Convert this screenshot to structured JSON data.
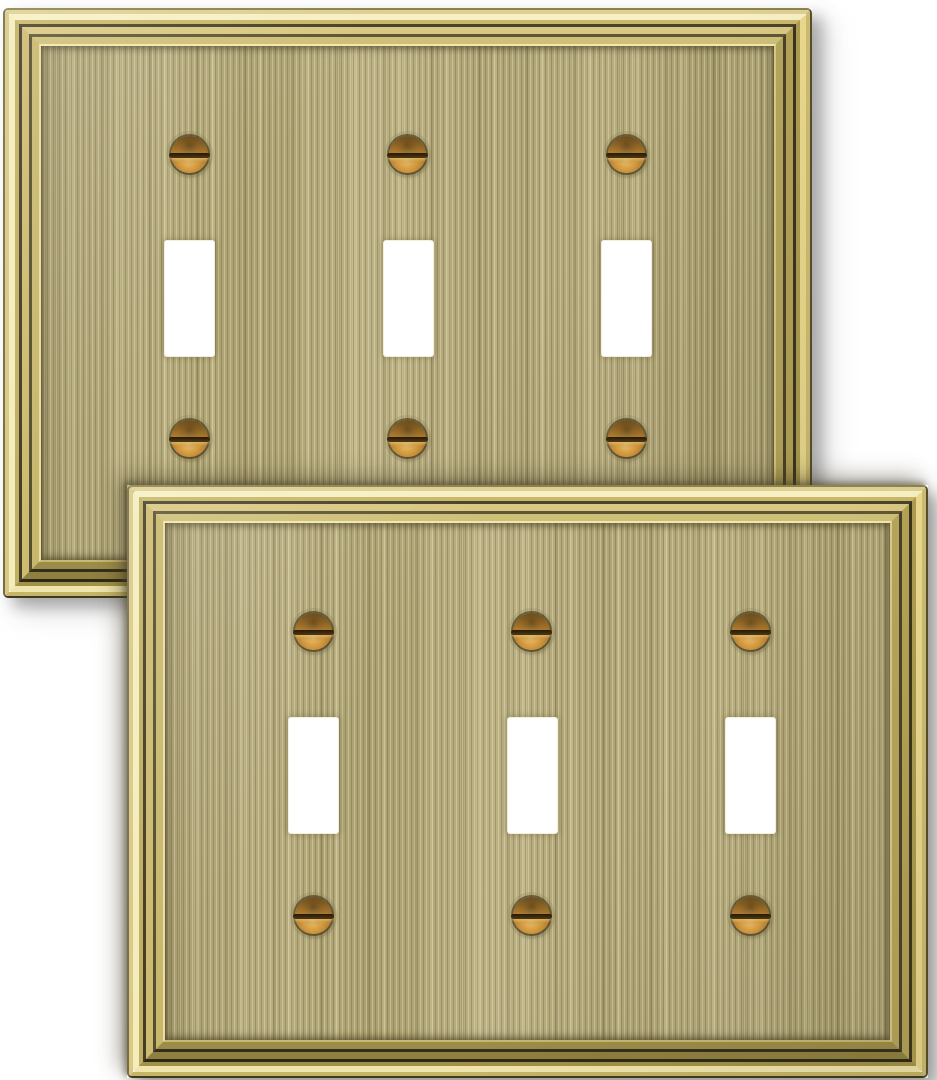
{
  "scene": {
    "description": "Product photo: two identical antique brass 3-gang toggle switch wall plates overlapping diagonally on a white background",
    "background_color": "#ffffff",
    "plate_count": 2
  },
  "plate": {
    "style": "stepped picture-frame molding with brushed vertical-grain metal field",
    "finish_name": "antique brushed brass",
    "gang_count": 3,
    "toggle_cutouts_per_plate": 3,
    "screws_per_plate": 6,
    "screw_type": "slotted round-head brass, horizontal slots",
    "colors": {
      "field_base": "#b2a778",
      "field_streak_light": "#cfc394",
      "field_streak_dark": "#8f855c",
      "frame_highlight": "#f7f0c4",
      "frame_gold": "#d6c57c",
      "frame_groove_dark": "#3a341f",
      "screw_brass": "#c8923c",
      "screw_slot": "#2e2310",
      "cutout": "#ffffff",
      "drop_shadow": "#9a9a9a"
    }
  }
}
